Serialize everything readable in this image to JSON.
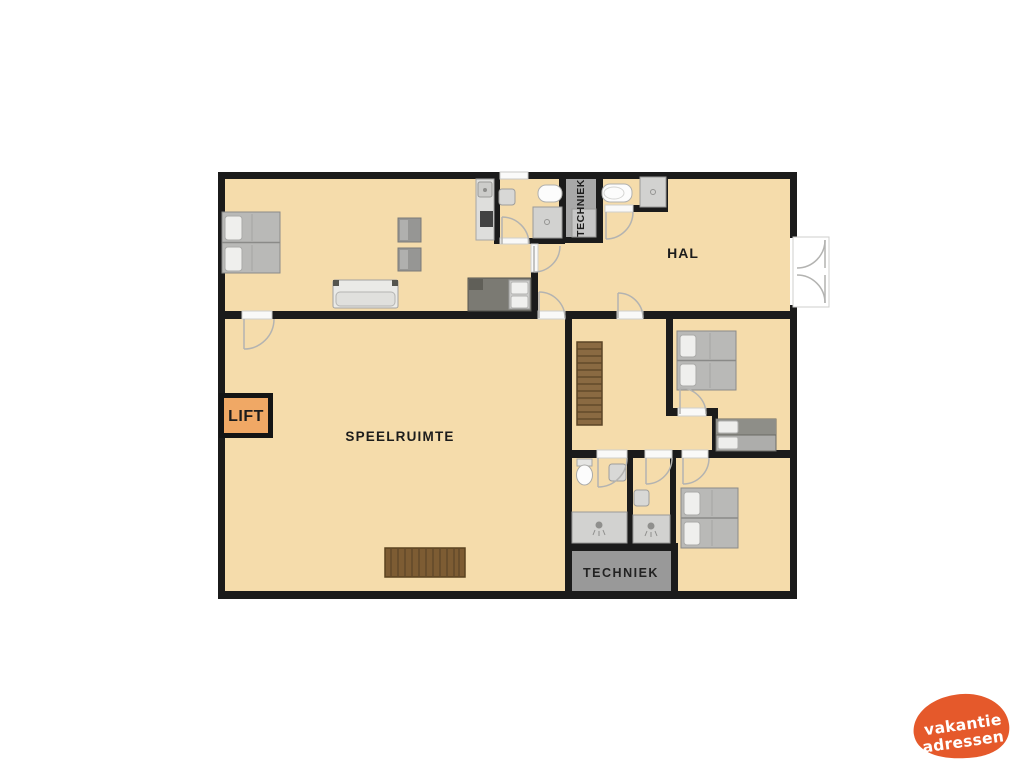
{
  "floorplan": {
    "labels": {
      "hal": "HAL",
      "speelruimte": "SPEELRUIMTE",
      "lift": "LIFT",
      "techniek_top": "TECHNIEK",
      "techniek_bottom": "TECHNIEK"
    },
    "colors": {
      "floor": "#f5dcab",
      "wall": "#1b1b1b",
      "lift": "#f0a865",
      "techniek_top_room": "#a8a8a8",
      "techniek_bottom_room": "#999999"
    }
  },
  "logo": {
    "line1": "vakantie",
    "line2": "adressen",
    "color": "#e5592b"
  }
}
